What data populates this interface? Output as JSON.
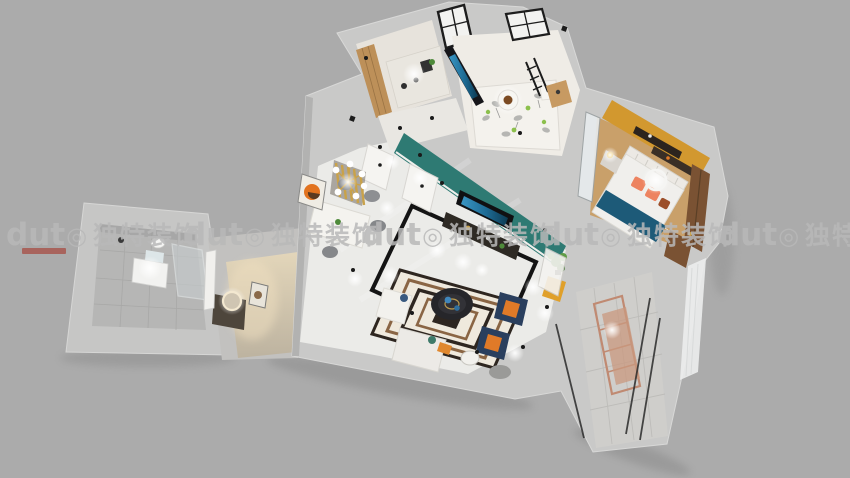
{
  "scene": {
    "description": "3D aerial dollhouse render of an apartment interior",
    "background_color": "#ababab"
  },
  "watermark": {
    "logo_text": "dut",
    "logo_symbol": "◎",
    "brand_text": "独特装饰",
    "text_color": "#b9b9b9",
    "accent_color": "#a8443a"
  },
  "palette": {
    "wall_light": "#c9c9c8",
    "wall_face_dark": "#b2b2b1",
    "floor_marble": "#ebebe8",
    "teal_wall": "#2e7a73",
    "orange_wall": "#d2982f",
    "blanket_teal": "#1d5a78",
    "pillow_coral": "#ed8360",
    "pillow_rust": "#9c4f2a",
    "armchair_navy": "#2a3f5e",
    "cushion_orange": "#e07a28",
    "sofa_white": "#f2f1ed",
    "rug_dark": "#2e2620",
    "rug_brown": "#8a6544",
    "rug_light": "#efe9dd",
    "gold": "#c9a24a",
    "copper_rack": "#c08a72",
    "yellow_seat": "#e0a02a",
    "plant_green": "#4e8a3a",
    "leaf_green": "#8cc04c",
    "wood_cabinet": "#bd9059",
    "wardrobe_brown": "#7a5233",
    "tile_gray": "#b6b6b5"
  }
}
